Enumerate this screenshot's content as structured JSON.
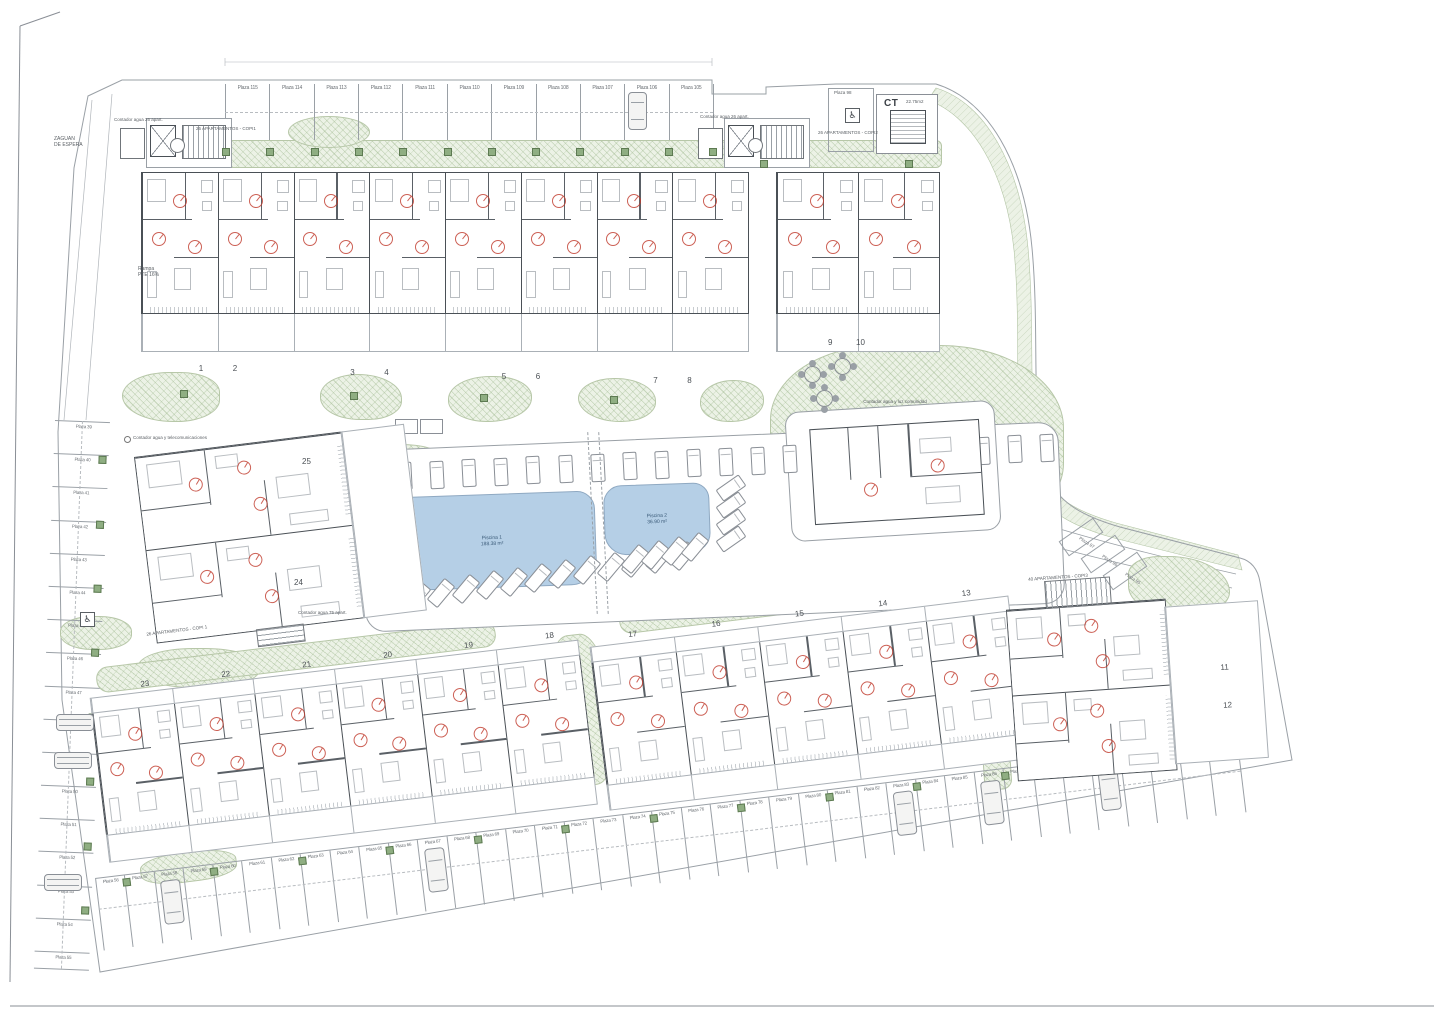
{
  "labels": {
    "zaguan": "ZAGUAN\nDE ESPERA",
    "rampa": "Rampa\nPTE 16%",
    "contador_left": "Contador agua 26 apart.",
    "contador_right": "Contador agua 26 apart.",
    "copi1_top": "26 APARTAMENTOS - COPI1",
    "copi2_top": "26 APARTAMENTOS - COPI2",
    "copi1_block": "26 APARTAMENTOS - COPI 1",
    "copi3_block": "40 APARTAMENTOS - COPI3",
    "contador_comunidad": "Contador agua y luz comunidad",
    "contador_75": "Contador agua 75 apart.",
    "nota_telecom": "Contador agua y telecomunicaciones",
    "ct": "CT",
    "ct_area": "22.75m2",
    "plaza98": "Plaza 98"
  },
  "pools": [
    {
      "name": "Piscina 1",
      "area": "188.38 m²"
    },
    {
      "name": "Piscina 2",
      "area": "36.90 m²"
    }
  ],
  "parking": {
    "top": [
      "Plaza 115",
      "Plaza 114",
      "Plaza 113",
      "Plaza 112",
      "Plaza 111",
      "Plaza 110",
      "Plaza 109",
      "Plaza 108",
      "Plaza 107",
      "Plaza 106",
      "Plaza 105"
    ],
    "left": [
      "Plaza 39",
      "Plaza 40",
      "Plaza 41",
      "Plaza 42",
      "Plaza 43",
      "Plaza 44",
      "Plaza 45",
      "Plaza 46",
      "Plaza 47",
      "Plaza 48",
      "Plaza 49",
      "Plaza 50",
      "Plaza 51",
      "Plaza 52",
      "Plaza 53",
      "Plaza 54",
      "Plaza 55"
    ],
    "bottom": [
      "Plaza 56",
      "Plaza 57",
      "Plaza 58",
      "Plaza 59",
      "Plaza 60",
      "Plaza 61",
      "Plaza 62",
      "Plaza 63",
      "Plaza 64",
      "Plaza 65",
      "Plaza 66",
      "Plaza 67",
      "Plaza 68",
      "Plaza 69",
      "Plaza 70",
      "Plaza 71",
      "Plaza 72",
      "Plaza 73",
      "Plaza 74",
      "Plaza 75",
      "Plaza 76",
      "Plaza 77",
      "Plaza 78",
      "Plaza 79",
      "Plaza 80",
      "Plaza 81",
      "Plaza 82",
      "Plaza 83",
      "Plaza 84",
      "Plaza 85",
      "Plaza 86",
      "Plaza 87",
      "Plaza 88",
      "Plaza 89",
      "Plaza 90",
      "Plaza 91",
      "Plaza 92",
      "Plaza 93",
      "Plaza 94"
    ],
    "right": [
      "Plaza 97",
      "Plaza 96",
      "Plaza 95"
    ]
  },
  "buildings": {
    "row_top": [
      "1",
      "2",
      "3",
      "4",
      "5",
      "6",
      "7",
      "8"
    ],
    "row_top_right": [
      "9",
      "10"
    ],
    "block_west": [
      "25",
      "24"
    ],
    "block_southwest": [
      "23",
      "22",
      "21",
      "20",
      "19",
      "18"
    ],
    "block_south": [
      "17",
      "16",
      "15",
      "14",
      "13"
    ],
    "block_southeast": [
      "11",
      "12"
    ]
  },
  "colors": {
    "green_area": "#ecf2e6",
    "pool": "#b5cfe6",
    "wall": "#4a5056",
    "line": "#9aa0a6",
    "door_arc": "#c0392b",
    "tree": "#8fae82"
  }
}
